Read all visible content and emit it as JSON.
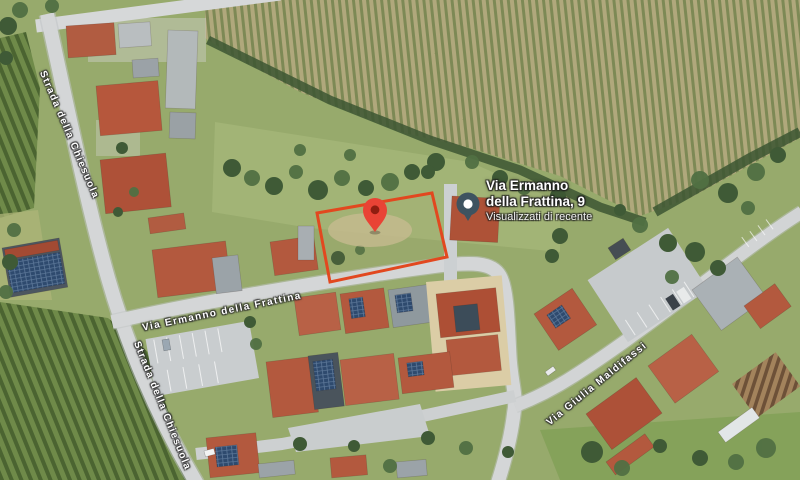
{
  "map": {
    "labels": {
      "street_chiesuola": "Strada della Chiesuola",
      "street_frattina": "Via Ermanno della Frattina",
      "street_maldifassi": "Via Giulia Maldifassi"
    },
    "place": {
      "title_line1": "Via Ermanno",
      "title_line2": "della Frattina, 9",
      "subtitle": "Visualizzati di recente"
    },
    "colors": {
      "plot_outline": "#e2481f",
      "marker": "#e94335",
      "marker_dot": "#8f1d10",
      "recent_pin": "#3e5360",
      "recent_pin_dot": "#ffffff"
    }
  }
}
